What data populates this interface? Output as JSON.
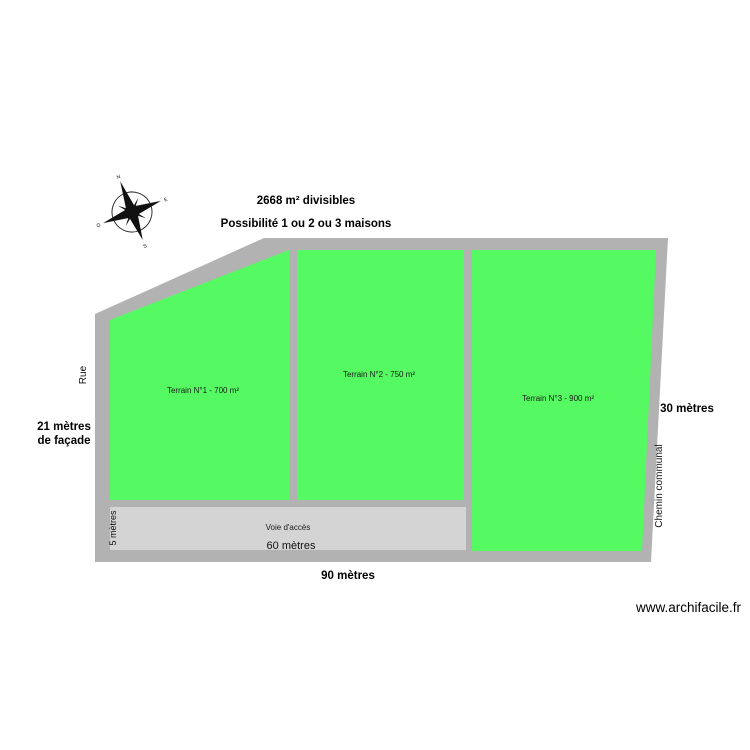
{
  "page": {
    "watermark": "www.archifacile.fr"
  },
  "colors": {
    "parcel_green": "#55fa62",
    "wall_gray": "#b2b2b2",
    "road_fill": "#d4d4d4",
    "compass_black": "#111111"
  },
  "annotations": {
    "title_line1": "2668 m² divisibles",
    "title_line2": "Possibilité 1 ou 2 ou 3 maisons",
    "facade_line1": "21 mètres",
    "facade_line2": "de façade",
    "bottom_total_width": "90 mètres",
    "right_depth": "30 mètres"
  },
  "streets": {
    "left": "Rue",
    "right": "Chemin communal"
  },
  "parcels": [
    {
      "label": "Terrain N°1 - 700 m²"
    },
    {
      "label": "Terrain N°2 - 750 m²"
    },
    {
      "label": "Terrain N°3 - 900 m²"
    }
  ],
  "access_road": {
    "label": "Voie d'accès",
    "length_label": "60 mètres",
    "width_label": "5 mètres"
  },
  "compass": {
    "north": "N",
    "south": "S",
    "east": "E",
    "west": "O"
  }
}
